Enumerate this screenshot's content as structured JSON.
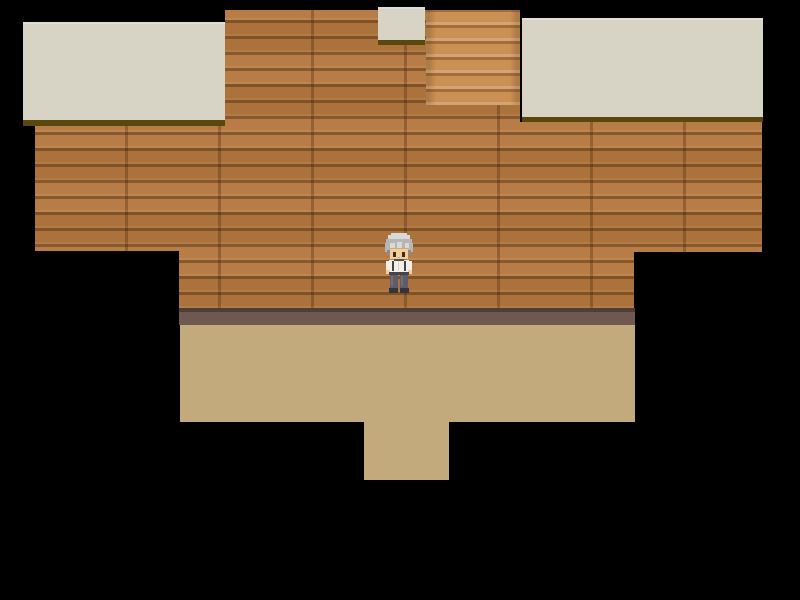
{
  "scene": {
    "title": "RPG Maker style top-down interior scene",
    "description": "Wooden plank building wall with two gray eave slabs, a small gray tile, a striped stair column, mauve wall base, tan floor with doorway notch, surrounded by black void.",
    "palette": {
      "bg": "#000000",
      "brick": "#b5783f",
      "roof": "#d7d4c5",
      "roofEdge": "#5a470c",
      "stairs": "#cb9053",
      "baseLine": "#4f3e33",
      "baseStrip": "#6e5851",
      "floor": "#c3aa7c"
    },
    "regions": [
      {
        "name": "roof-left",
        "kind": "eave slab",
        "color": "#d7d4c5"
      },
      {
        "name": "roof-small",
        "kind": "eave tile above doorway",
        "color": "#d7d4c5"
      },
      {
        "name": "roof-right",
        "kind": "eave slab",
        "color": "#d7d4c5"
      },
      {
        "name": "stairs",
        "kind": "striped wood column",
        "color": "#cb9053"
      },
      {
        "name": "wall-bricks",
        "kind": "horizontal wooden plank wall",
        "color": "#b5783f"
      },
      {
        "name": "wall-base-strip",
        "kind": "mauve skirting between wall and floor",
        "color": "#6e5851"
      },
      {
        "name": "floor",
        "kind": "tan floor with doorway notch at bottom",
        "color": "#c3aa7c"
      }
    ],
    "character": {
      "name": "player-character",
      "description": "Silver spiky-haired villager, white shirt with dark suspenders, gray trousers, dark shoes, facing down",
      "approx_position": {
        "x": 399,
        "y": 264
      },
      "palette": {
        "hairLight": "#d9d9d9",
        "hairMid": "#b6b6b6",
        "hairDark": "#8c8c8c",
        "skin": "#f1cf9d",
        "skinShade": "#d8a873",
        "eye": "#3d2b20",
        "shirt": "#f1f0e9",
        "collar": "#52504e",
        "strap": "#46434b",
        "placket": "#d9d6cb",
        "pants": "#5d5c68",
        "pantsHi": "#6e6d7a",
        "shoes": "#35333b"
      }
    }
  }
}
